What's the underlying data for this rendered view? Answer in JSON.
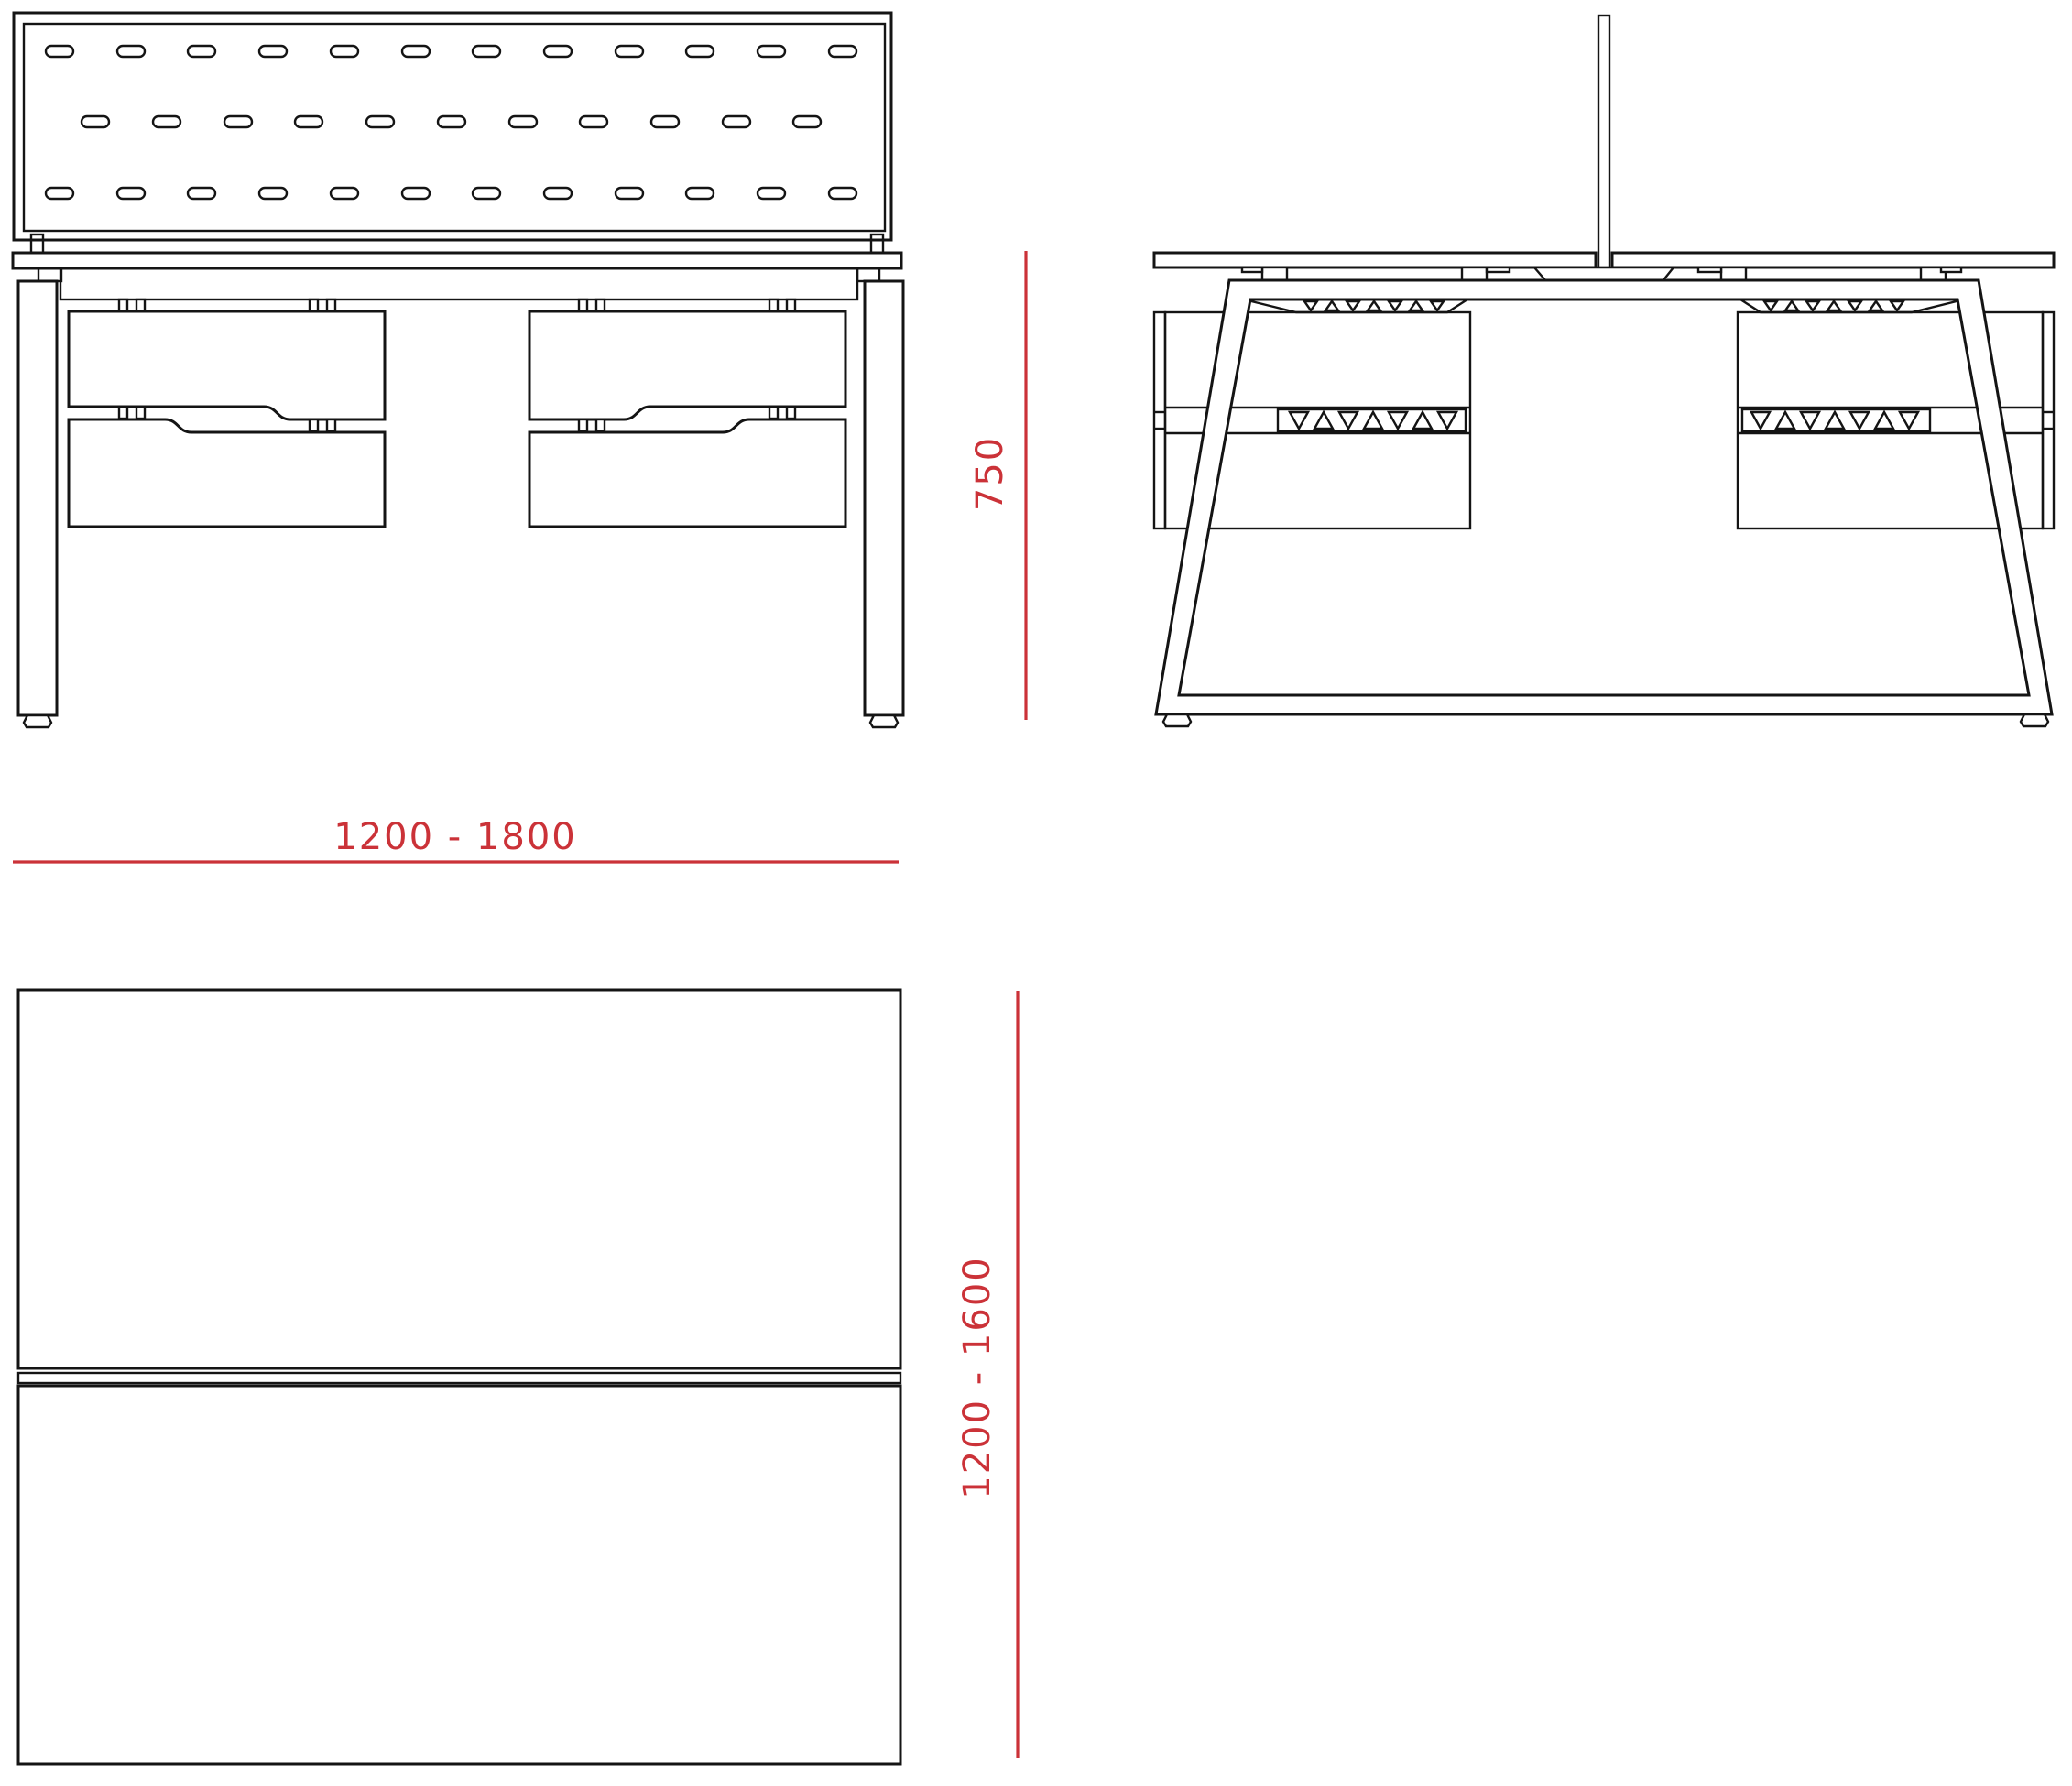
{
  "drawing": {
    "dimension_labels": {
      "width": "1200 - 1800",
      "height": "750",
      "depth": "1200 - 1600"
    },
    "colors": {
      "dimension_red": "#cb3238",
      "line_black": "#141414",
      "background": "#ffffff"
    }
  }
}
